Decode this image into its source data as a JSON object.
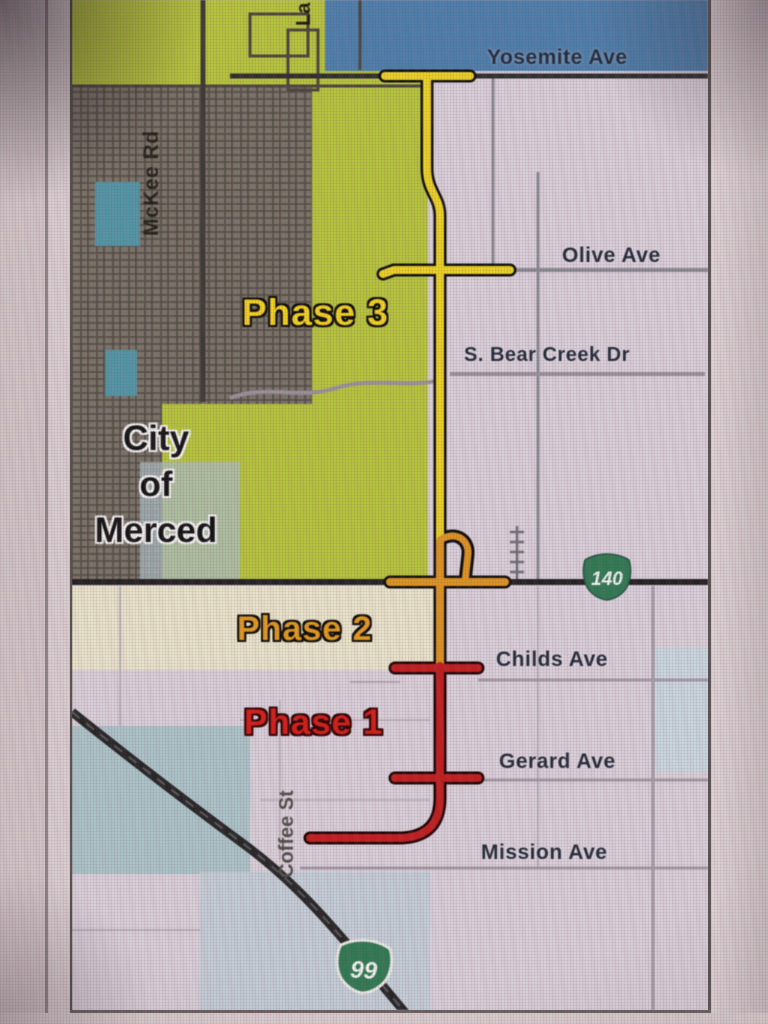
{
  "streets": {
    "yosemite": "Yosemite Ave",
    "olive": "Olive Ave",
    "bear_creek": "S. Bear Creek Dr",
    "childs": "Childs Ave",
    "gerard": "Gerard Ave",
    "mission": "Mission Ave",
    "mckee": "McKee Rd",
    "coffee": "Coffee St",
    "la_partial": "La"
  },
  "phases": {
    "phase1": {
      "label": "Phase 1",
      "color": "#d91d15"
    },
    "phase2": {
      "label": "Phase 2",
      "color": "#e59a16"
    },
    "phase3": {
      "label": "Phase 3",
      "color": "#f4d218"
    }
  },
  "city_label": "City\nof\nMerced",
  "shields": {
    "sr140": "140",
    "us99": "99",
    "shield_color": "#2e7b52"
  },
  "zone_colors": {
    "city_limits_green": "#b5c437",
    "urban_gray": "#7b7468",
    "water_teal": "#4f97a6",
    "north_blue": "#4c7fae",
    "map_background": "#d8cfd8",
    "phase1_route": "#c61d1d",
    "phase2_route": "#df931c",
    "phase3_route": "#ecd11c",
    "highway_dark": "#262626"
  }
}
